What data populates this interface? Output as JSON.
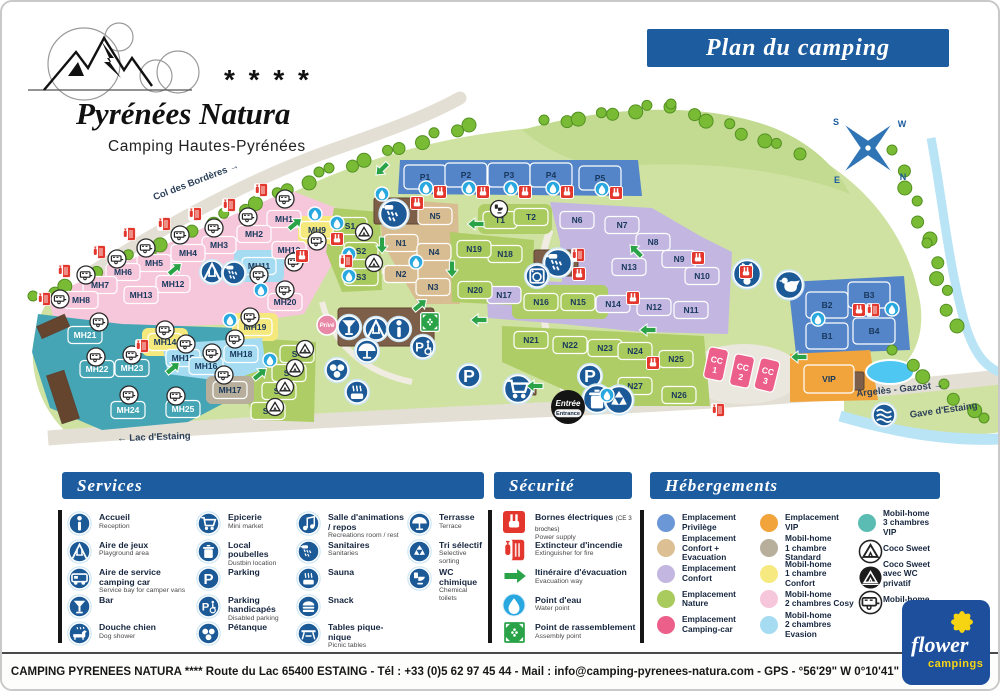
{
  "header": {
    "banner": "Plan du camping",
    "logo": {
      "stars": "* * * *",
      "title": "Pyrénées Natura",
      "subtitle": "Camping Hautes-Pyrénées"
    }
  },
  "compass": {
    "s": "S",
    "w": "W",
    "e": "E",
    "n": "N"
  },
  "map": {
    "entrance": {
      "fr": "Entrée",
      "en": "Entrance"
    },
    "prive": "Privé",
    "labels": [
      {
        "text": "Col des Bordères  →",
        "x": 195,
        "y": 182,
        "rot": -21
      },
      {
        "text": "←  Lac d'Estaing",
        "x": 152,
        "y": 438,
        "rot": -2
      },
      {
        "text": "Argelès - Gazost  →",
        "x": 898,
        "y": 390,
        "rot": -6
      },
      {
        "text": "Gave d'Estaing",
        "x": 942,
        "y": 411,
        "rot": -8
      }
    ],
    "plot_colors": {
      "priv": "#5585c9",
      "cevac": "#d9bd92",
      "conf": "#c3b7e1",
      "nat": "#a9ca5c",
      "cc": "#ec5f8a",
      "vip": "#f2a43c",
      "std": "#b7af9c",
      "mh1c": "#f5e87d",
      "cosy": "#f6c6da",
      "eva": "#a6dcf2",
      "vip3": "#45a5b5"
    },
    "plots": [
      [
        "MH1",
        282,
        217,
        "cosy"
      ],
      [
        "MH2",
        252,
        232,
        "cosy"
      ],
      [
        "MH3",
        217,
        243,
        "cosy"
      ],
      [
        "MH4",
        186,
        251,
        "cosy"
      ],
      [
        "MH5",
        152,
        261,
        "cosy"
      ],
      [
        "MH6",
        121,
        270,
        "cosy"
      ],
      [
        "MH7",
        98,
        283,
        "cosy"
      ],
      [
        "MH8",
        79,
        298,
        "cosy"
      ],
      [
        "MH9",
        315,
        228,
        "mh1c"
      ],
      [
        "MH10",
        287,
        248,
        "cosy"
      ],
      [
        "MH11",
        257,
        264,
        "eva"
      ],
      [
        "MH12",
        171,
        282,
        "cosy"
      ],
      [
        "MH13",
        139,
        293,
        "cosy"
      ],
      [
        "MH14",
        163,
        340,
        "mh1c"
      ],
      [
        "MH15",
        181,
        356,
        "eva"
      ],
      [
        "MH16",
        204,
        364,
        "eva"
      ],
      [
        "MH17",
        228,
        388,
        "std"
      ],
      [
        "MH18",
        239,
        352,
        "eva"
      ],
      [
        "MH19",
        253,
        325,
        "mh1c"
      ],
      [
        "MH20",
        283,
        300,
        "cosy"
      ],
      [
        "MH21",
        83,
        333,
        "vip3"
      ],
      [
        "MH22",
        95,
        367,
        "vip3"
      ],
      [
        "MH23",
        130,
        366,
        "vip3"
      ],
      [
        "MH24",
        126,
        408,
        "vip3"
      ],
      [
        "MH25",
        181,
        407,
        "vip3"
      ],
      [
        "S1",
        348,
        224,
        "nat"
      ],
      [
        "S2",
        359,
        249,
        "nat"
      ],
      [
        "S3",
        359,
        275,
        "nat"
      ],
      [
        "S4",
        295,
        352,
        "nat"
      ],
      [
        "S5",
        287,
        371,
        "nat"
      ],
      [
        "S6",
        277,
        389,
        "nat"
      ],
      [
        "S7",
        266,
        409,
        "nat"
      ],
      [
        "P1",
        423,
        175,
        "priv",
        42,
        24
      ],
      [
        "P2",
        464,
        173,
        "priv",
        42,
        24
      ],
      [
        "P3",
        507,
        173,
        "priv",
        42,
        24
      ],
      [
        "P4",
        549,
        173,
        "priv",
        42,
        24
      ],
      [
        "P5",
        598,
        176,
        "priv",
        42,
        24
      ],
      [
        "T1",
        498,
        218,
        "nat"
      ],
      [
        "T2",
        529,
        215,
        "nat"
      ],
      [
        "N1",
        399,
        241,
        "cevac"
      ],
      [
        "N2",
        399,
        272,
        "cevac"
      ],
      [
        "N3",
        431,
        285,
        "cevac"
      ],
      [
        "N4",
        432,
        250,
        "cevac"
      ],
      [
        "N5",
        433,
        214,
        "cevac"
      ],
      [
        "N6",
        575,
        218,
        "conf"
      ],
      [
        "N7",
        620,
        223,
        "conf"
      ],
      [
        "N8",
        651,
        240,
        "conf"
      ],
      [
        "N9",
        677,
        257,
        "conf"
      ],
      [
        "N10",
        700,
        274,
        "conf"
      ],
      [
        "N11",
        689,
        308,
        "conf"
      ],
      [
        "N12",
        652,
        305,
        "conf"
      ],
      [
        "N13",
        627,
        265,
        "conf"
      ],
      [
        "N14",
        611,
        302,
        "conf"
      ],
      [
        "N15",
        576,
        300,
        "nat"
      ],
      [
        "N16",
        539,
        300,
        "nat"
      ],
      [
        "N17",
        502,
        293,
        "conf"
      ],
      [
        "N18",
        503,
        252,
        "nat"
      ],
      [
        "N19",
        472,
        247,
        "nat"
      ],
      [
        "N20",
        473,
        288,
        "nat"
      ],
      [
        "N21",
        529,
        338,
        "nat"
      ],
      [
        "N22",
        568,
        343,
        "nat"
      ],
      [
        "N23",
        603,
        346,
        "nat"
      ],
      [
        "N24",
        633,
        349,
        "nat"
      ],
      [
        "N25",
        674,
        357,
        "nat"
      ],
      [
        "N26",
        677,
        393,
        "nat"
      ],
      [
        "N27",
        633,
        384,
        "nat"
      ],
      [
        "B1",
        825,
        334,
        "priv",
        42,
        26
      ],
      [
        "B2",
        825,
        303,
        "priv",
        42,
        26
      ],
      [
        "B3",
        867,
        293,
        "priv",
        42,
        26
      ],
      [
        "B4",
        872,
        329,
        "priv",
        42,
        26
      ],
      [
        "CC 1",
        714,
        362,
        "cc",
        20,
        32,
        12
      ],
      [
        "CC 2",
        740,
        369,
        "cc",
        20,
        32,
        12
      ],
      [
        "CC 3",
        765,
        373,
        "cc",
        20,
        32,
        14
      ],
      [
        "VIP",
        827,
        377,
        "vip",
        50,
        28
      ]
    ],
    "icons": {
      "water": [
        [
          335,
          221
        ],
        [
          347,
          252
        ],
        [
          347,
          274
        ],
        [
          380,
          192
        ],
        [
          424,
          186
        ],
        [
          467,
          186
        ],
        [
          509,
          186
        ],
        [
          551,
          186
        ],
        [
          600,
          187
        ],
        [
          313,
          212
        ],
        [
          414,
          260
        ],
        [
          259,
          288
        ],
        [
          268,
          358
        ],
        [
          816,
          317
        ],
        [
          890,
          307
        ],
        [
          605,
          393
        ],
        [
          228,
          318
        ]
      ],
      "power": [
        [
          335,
          237
        ],
        [
          438,
          190
        ],
        [
          481,
          190
        ],
        [
          523,
          190
        ],
        [
          565,
          190
        ],
        [
          614,
          191
        ],
        [
          415,
          201
        ],
        [
          577,
          272
        ],
        [
          696,
          256
        ],
        [
          744,
          270
        ],
        [
          857,
          308
        ],
        [
          631,
          296
        ],
        [
          300,
          254
        ],
        [
          651,
          361
        ]
      ],
      "ext": [
        [
          259,
          188
        ],
        [
          227,
          203
        ],
        [
          193,
          212
        ],
        [
          162,
          222
        ],
        [
          127,
          232
        ],
        [
          97,
          250
        ],
        [
          62,
          269
        ],
        [
          42,
          297
        ],
        [
          344,
          259
        ],
        [
          576,
          253
        ],
        [
          140,
          344
        ],
        [
          716,
          408
        ],
        [
          871,
          308
        ]
      ],
      "evac": [
        [
          293,
          222,
          -40
        ],
        [
          173,
          267,
          -40
        ],
        [
          171,
          366,
          -40
        ],
        [
          258,
          372,
          -40
        ],
        [
          380,
          243,
          90
        ],
        [
          450,
          267,
          90
        ],
        [
          474,
          222,
          180
        ],
        [
          634,
          249,
          225
        ],
        [
          646,
          328,
          180
        ],
        [
          477,
          318,
          180
        ],
        [
          533,
          384,
          180
        ],
        [
          797,
          355,
          180
        ],
        [
          418,
          303,
          -40
        ],
        [
          380,
          167,
          135
        ]
      ],
      "assembly": [
        [
          428,
          320
        ]
      ],
      "mobilhome": [
        [
          283,
          197
        ],
        [
          246,
          215
        ],
        [
          212,
          226
        ],
        [
          178,
          233
        ],
        [
          144,
          246
        ],
        [
          115,
          257
        ],
        [
          84,
          273
        ],
        [
          58,
          297
        ],
        [
          163,
          328
        ],
        [
          184,
          342
        ],
        [
          210,
          351
        ],
        [
          222,
          373
        ],
        [
          233,
          337
        ],
        [
          97,
          320
        ],
        [
          94,
          355
        ],
        [
          130,
          353
        ],
        [
          127,
          393
        ],
        [
          174,
          394
        ],
        [
          315,
          239
        ],
        [
          292,
          260
        ],
        [
          257,
          273
        ],
        [
          283,
          288
        ],
        [
          248,
          315
        ]
      ],
      "coco": [
        [
          362,
          230
        ],
        [
          372,
          261
        ],
        [
          303,
          347
        ],
        [
          293,
          366
        ],
        [
          283,
          385
        ],
        [
          273,
          405
        ]
      ],
      "services": [
        [
          "sanit",
          392,
          212,
          1
        ],
        [
          "sanit",
          556,
          261,
          1
        ],
        [
          "wash",
          535,
          274,
          0
        ],
        [
          "play",
          210,
          270,
          0
        ],
        [
          "sanit",
          232,
          271,
          0
        ],
        [
          "bar",
          347,
          325,
          0
        ],
        [
          "play",
          374,
          327,
          0
        ],
        [
          "info",
          397,
          327,
          0
        ],
        [
          "terr",
          365,
          349,
          0
        ],
        [
          "phand",
          421,
          345,
          0
        ],
        [
          "pet",
          335,
          368,
          0
        ],
        [
          "sauna",
          355,
          390,
          0
        ],
        [
          "park",
          467,
          374,
          0
        ],
        [
          "cart",
          516,
          387,
          1
        ],
        [
          "park",
          588,
          374,
          0
        ],
        [
          "trash",
          595,
          397,
          1
        ],
        [
          "tri",
          617,
          398,
          1
        ],
        [
          "rabbit",
          745,
          272,
          1
        ],
        [
          "hen",
          787,
          283,
          1
        ],
        [
          "wave",
          882,
          413,
          0
        ]
      ],
      "wc_white": [
        [
          497,
          207
        ]
      ]
    }
  },
  "legend": {
    "services": {
      "title": "Services",
      "columns": [
        [
          {
            "fr": "Accueil",
            "en": "Reception",
            "icon": "info"
          },
          {
            "fr": "Aire de jeux",
            "en": "Playground area",
            "icon": "play"
          },
          {
            "fr": "Aire de service camping car",
            "en": "Service bay for camper vans",
            "icon": "camper"
          },
          {
            "fr": "Bar",
            "en": "",
            "icon": "bar"
          },
          {
            "fr": "Douche chien",
            "en": "Dog shower",
            "icon": "dog"
          }
        ],
        [
          {
            "fr": "Epicerie",
            "en": "Mini market",
            "icon": "cart"
          },
          {
            "fr": "Local poubelles",
            "en": "Dustbin location",
            "icon": "trash"
          },
          {
            "fr": "Parking",
            "en": "",
            "icon": "park"
          },
          {
            "fr": "Parking handicapés",
            "en": "Disabled parking",
            "icon": "phand"
          },
          {
            "fr": "Pétanque",
            "en": "",
            "icon": "pet"
          }
        ],
        [
          {
            "fr": "Salle d'animations / repos",
            "en": "Recreations room / rest",
            "icon": "anim"
          },
          {
            "fr": "Sanitaires",
            "en": "Sanitaries",
            "icon": "sanit"
          },
          {
            "fr": "Sauna",
            "en": "",
            "icon": "sauna"
          },
          {
            "fr": "Snack",
            "en": "",
            "icon": "snack"
          },
          {
            "fr": "Tables pique-nique",
            "en": "Picnic tables",
            "icon": "picnic"
          }
        ],
        [
          {
            "fr": "Terrasse",
            "en": "Terrace",
            "icon": "terr"
          },
          {
            "fr": "Tri sélectif",
            "en": "Selective sorting",
            "icon": "tri"
          },
          {
            "fr": "WC chimique",
            "en": "Chemical toilets",
            "icon": "wc"
          }
        ]
      ]
    },
    "security": {
      "title": "Sécurité",
      "items": [
        {
          "fr": "Bornes électriques",
          "note": "(CE 3 broches)",
          "en": "Power supply",
          "icon": "power"
        },
        {
          "fr": "Extincteur d'incendie",
          "en": "Extinguisher for fire",
          "icon": "ext"
        },
        {
          "fr": "Itinéraire d'évacuation",
          "en": "Evacuation way",
          "icon": "evac"
        },
        {
          "fr": "Point d'eau",
          "en": "Water point",
          "icon": "water"
        },
        {
          "fr": "Point de rassemblement",
          "en": "Assembly point",
          "icon": "assembly"
        }
      ]
    },
    "accommodations": {
      "title": "Hébergements",
      "columns": [
        [
          {
            "l1": "Emplacement",
            "l2": "Privilège",
            "color": "#6b97d6"
          },
          {
            "l1": "Emplacement",
            "l2": "Confort + Evacuation",
            "color": "#dcc094"
          },
          {
            "l1": "Emplacement",
            "l2": "Confort",
            "color": "#c3b7e1"
          },
          {
            "l1": "Emplacement",
            "l2": "Nature",
            "color": "#a9ca5c"
          },
          {
            "l1": "Emplacement",
            "l2": "Camping-car",
            "color": "#ec5f8a"
          }
        ],
        [
          {
            "l1": "Emplacement",
            "l2": "VIP",
            "color": "#f2a43c"
          },
          {
            "l1": "Mobil-home",
            "l2": "1 chambre Standard",
            "color": "#b7af9c"
          },
          {
            "l1": "Mobil-home",
            "l2": "1 chambre Confort",
            "color": "#f6e97f"
          },
          {
            "l1": "Mobil-home",
            "l2": "2 chambres Cosy",
            "color": "#f6c6da"
          },
          {
            "l1": "Mobil-home",
            "l2": "2 chambres Evasion",
            "color": "#a6dcf2"
          }
        ],
        [
          {
            "l1": "Mobil-home",
            "l2": "3 chambres VIP",
            "color": "#5bbcb4"
          },
          {
            "l1": "Coco Sweet",
            "l2": "",
            "icon": "coco"
          },
          {
            "l1": "Coco Sweet",
            "l2": "avec WC privatif",
            "icon": "cocop"
          },
          {
            "l1": "Mobil-home",
            "l2": "",
            "icon": "mh"
          }
        ]
      ]
    }
  },
  "footer": {
    "text": "CAMPING PYRENEES NATURA **** Route du Lac 65400 ESTAING - Tél : +33 (0)5 62 97 45 44 - Mail : info@camping-pyrenees-natura.com - GPS - °56'29\" W 0°10'41\""
  },
  "brand": {
    "line1": "flower",
    "line2": "campings"
  }
}
